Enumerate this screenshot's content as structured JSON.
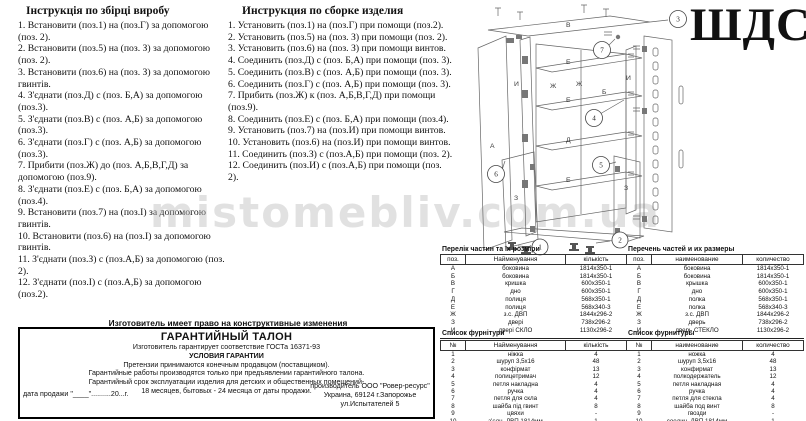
{
  "page": {
    "title": "ШДС",
    "watermark": "mistomebliv.com.ua",
    "colors": {
      "paper": "#ffffff",
      "ink": "#000000",
      "watermark": "#b9b9b9"
    }
  },
  "instructions_ua": {
    "title": "Інструкція по збірці виробу",
    "items": [
      "1. Встановити (поз.1) на (поз.Г) за допомогою (поз. 2).",
      "2. Встановити (поз.5) на (поз. З) за допомогою (поз. 2).",
      "3. Встановити (поз.6) на (поз. З) за допомогою гвинтів.",
      "4. З'єднати (поз.Д) с (поз. Б,А) за допомогою (поз.3).",
      "5. З'єднати (поз.В) с (поз. А,Б) за допомогою (поз.3).",
      "6. З'єднати (поз.Г) с (поз. А,Б) за допомогою (поз.3).",
      "7. Прибити (поз.Ж) до (поз. А,Б,В,Г,Д) за допомогою (поз.9).",
      "8. З'єднати (поз.Е) с (поз. Б,А) за допомогою (поз.4).",
      "9. Встановити (поз.7) на (поз.І) за допомогою гвинтів.",
      "10. Встановити (поз.6) на (поз.І) за допомогою гвинтів.",
      "11. З'єднати (поз.З) с (поз.А,Б) за допомогою (поз. 2).",
      "12. З'єднати (поз.І) с (поз.А,Б) за допомогою (поз.2)."
    ]
  },
  "instructions_ru": {
    "title": "Инструкция по сборке изделия",
    "items": [
      "1. Установить (поз.1) на (поз.Г) при помощи (поз.2).",
      "2. Установить (поз.5) на (поз. З) при помощи (поз. 2).",
      "3. Установить (поз.6) на (поз. З) при помощи винтов.",
      "4. Соединить (поз.Д) с (поз. Б,А) при помощи (поз. 3).",
      "5. Соединить (поз.В) с (поз. А,Б) при помощи (поз. 3).",
      "6. Соединить (поз.Г) с (поз. А,Б) при помощи (поз. 3).",
      "7. Прибить (поз.Ж) к (поз. А,Б,В,Г,Д) при помощи (поз.9).",
      "8. Соединить (поз.Е) с (поз. Б,А) при помощи (поз.4).",
      "9. Установить (поз.7) на (поз.И) при помощи винтов.",
      "10. Установить (поз.6) на (поз.И) при помощи винтов.",
      "11. Соединить (поз.З) с (поз.А,Б) при помощи (поз. 2).",
      "12. Соединить (поз.И) с (поз.А,Б) при помощи (поз. 2)."
    ]
  },
  "parts_ua": {
    "title": "Перелік частин та їх розміри",
    "headers": {
      "pos": "поз.",
      "name": "Найменування",
      "qty": "кількість"
    },
    "rows": [
      {
        "pos": "А",
        "name": "боковина",
        "qty": "1814х350-1"
      },
      {
        "pos": "Б",
        "name": "боковина",
        "qty": "1814х350-1"
      },
      {
        "pos": "В",
        "name": "кришка",
        "qty": "600х350-1"
      },
      {
        "pos": "Г",
        "name": "дно",
        "qty": "600х350-1"
      },
      {
        "pos": "Д",
        "name": "полиця",
        "qty": "568х350-1"
      },
      {
        "pos": "Е",
        "name": "полиця",
        "qty": "568х340-3"
      },
      {
        "pos": "Ж",
        "name": "з.с. ДВП",
        "qty": "1844х296-2"
      },
      {
        "pos": "З",
        "name": "дверi",
        "qty": "738х296-2"
      },
      {
        "pos": "И",
        "name": "дверi СКЛО",
        "qty": "1130х296-2"
      }
    ]
  },
  "parts_ru": {
    "title": "Перечень частей и их размеры",
    "headers": {
      "pos": "поз.",
      "name": "наименование",
      "qty": "количество"
    },
    "rows": [
      {
        "pos": "А",
        "name": "боковина",
        "qty": "1814х350-1"
      },
      {
        "pos": "Б",
        "name": "боковина",
        "qty": "1814х350-1"
      },
      {
        "pos": "В",
        "name": "крышка",
        "qty": "600х350-1"
      },
      {
        "pos": "Г",
        "name": "дно",
        "qty": "600х350-1"
      },
      {
        "pos": "Д",
        "name": "полка",
        "qty": "568х350-1"
      },
      {
        "pos": "Е",
        "name": "полка",
        "qty": "568х340-3"
      },
      {
        "pos": "Ж",
        "name": "з.с. ДВП",
        "qty": "1844х296-2"
      },
      {
        "pos": "З",
        "name": "дверь",
        "qty": "738х296-2"
      },
      {
        "pos": "И",
        "name": "дверь СТЕКЛО",
        "qty": "1130х296-2"
      }
    ]
  },
  "hardware_ua": {
    "title": "Список фурнітури",
    "headers": {
      "num": "№",
      "name": "Найменування",
      "qty": "кількість"
    },
    "rows": [
      {
        "num": "1",
        "name": "нiжка",
        "qty": "4"
      },
      {
        "num": "2",
        "name": "шуруп 3,5х16",
        "qty": "48"
      },
      {
        "num": "3",
        "name": "конфiрмат",
        "qty": "13"
      },
      {
        "num": "4",
        "name": "полицетримач",
        "qty": "12"
      },
      {
        "num": "5",
        "name": "петля накладна",
        "qty": "4"
      },
      {
        "num": "6",
        "name": "ручка",
        "qty": "4"
      },
      {
        "num": "7",
        "name": "петля для скла",
        "qty": "4"
      },
      {
        "num": "8",
        "name": "шайба пiд гвинт",
        "qty": "8"
      },
      {
        "num": "9",
        "name": "цвяхи",
        "qty": "-"
      },
      {
        "num": "10",
        "name": "з'єдн. ДВП 1814мм",
        "qty": "1"
      }
    ]
  },
  "hardware_ru": {
    "title": "Список фурнитуры",
    "headers": {
      "num": "№",
      "name": "наименование",
      "qty": "количество"
    },
    "rows": [
      {
        "num": "1",
        "name": "ножка",
        "qty": "4"
      },
      {
        "num": "2",
        "name": "шуруп 3,5х16",
        "qty": "48"
      },
      {
        "num": "3",
        "name": "конфирмат",
        "qty": "13"
      },
      {
        "num": "4",
        "name": "полкодержатель",
        "qty": "12"
      },
      {
        "num": "5",
        "name": "петля накладная",
        "qty": "4"
      },
      {
        "num": "6",
        "name": "ручка",
        "qty": "4"
      },
      {
        "num": "7",
        "name": "петля для стекла",
        "qty": "4"
      },
      {
        "num": "8",
        "name": "шайба под винт",
        "qty": "8"
      },
      {
        "num": "9",
        "name": "гвозди",
        "qty": "-"
      },
      {
        "num": "10",
        "name": "соедин. ДВП 1814мм",
        "qty": "1"
      }
    ]
  },
  "warranty": {
    "note_above": "Изготовитель имеет право на конструктивные изменения",
    "title": "ГАРАНТИЙНЫЙ ТАЛОН",
    "line1": "Изготовитель гарантирует соответствие ГОСТа 16371-93",
    "subtitle": "УСЛОВИЯ ГАРАНТИИ",
    "line2": "Претензии принимаются конечным продавцом (поставщиком).",
    "line3": "Гарантийные работы производятся только при предъявлении гарантийного талона.",
    "line4": "Гарантийный срок эксплуатации изделия для детских и общественных помещений-",
    "line5": "18 месяцев, бытовых - 24 месяца от даты продажи.",
    "date_line": "дата продажи \"____\"..........20...г.",
    "maker1": "производитель ООО \"Ровер-ресурс\"",
    "maker2": "Украина, 69124 г.Запорожье",
    "maker3": "ул.Испытателей 5"
  },
  "drawing": {
    "labels": {
      "top_panel": "В",
      "left_door": "А",
      "back_left": "Ж",
      "back_right": "Ж",
      "inner_door": "И",
      "right_side": "Б",
      "glass_door": "И",
      "shelf_top": "Е",
      "shelf_mid": "Е",
      "shelf_d": "Д",
      "shelf_low": "Е",
      "lower_door_left": "З",
      "lower_door_right": "З"
    },
    "callouts": {
      "c1": "1",
      "c2": "2",
      "c3": "3",
      "c4": "4",
      "c5": "5",
      "c6": "6",
      "c7": "7"
    }
  }
}
